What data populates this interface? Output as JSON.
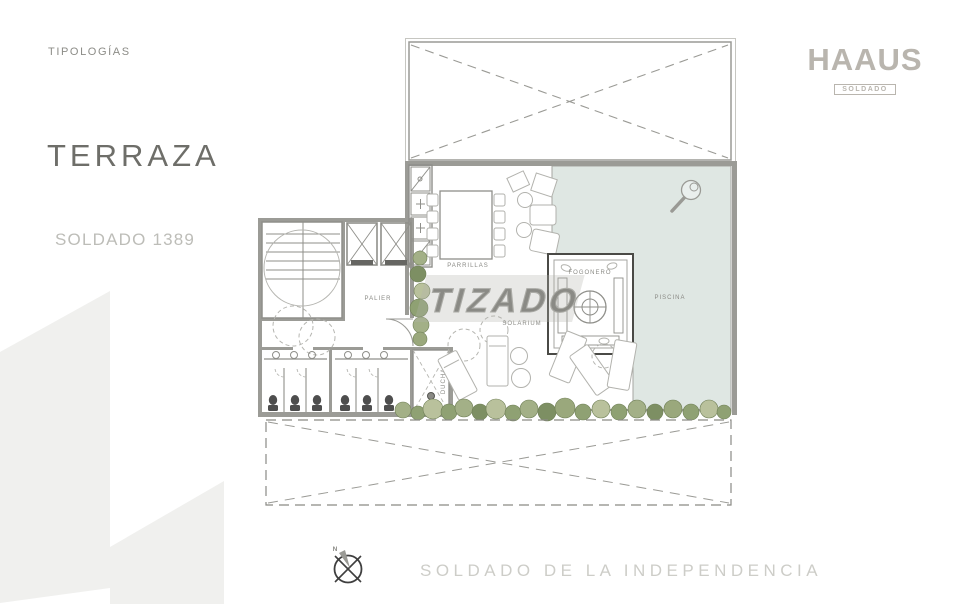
{
  "sidebar": {
    "section_label": "TIPOLOGÍAS",
    "title": "TERRAZA",
    "subtitle": "SOLDADO 1389"
  },
  "brand": {
    "name": "HAAUS",
    "badge": "SOLDADO"
  },
  "watermark": {
    "text": "TIZADO"
  },
  "plan": {
    "rooms": {
      "palier": "PALIER",
      "parrillas": "PARRILLAS",
      "solarium": "SOLARIUM",
      "fogonero": "FOGONERO",
      "piscina": "PISCINA",
      "ducha": "DUCHA"
    },
    "colors": {
      "pool_fill": "#dfe7e3",
      "wall_gray": "#9b9b96",
      "line_gray": "#8f8f8a",
      "furniture_gray": "#b2b2ad",
      "plant_dark": "#7d8f63",
      "plant_mid": "#9aa87c",
      "plant_light": "#b9c19c",
      "brand_gray": "#b9b5ae",
      "title_gray": "#6e6e69",
      "subtitle_gray": "#bdbdb8",
      "street_gray": "#cdcdc8",
      "deco_gray": "#f0f0ee"
    }
  },
  "footer": {
    "street": "SOLDADO DE LA INDEPENDENCIA",
    "compass_north_label": "N"
  }
}
